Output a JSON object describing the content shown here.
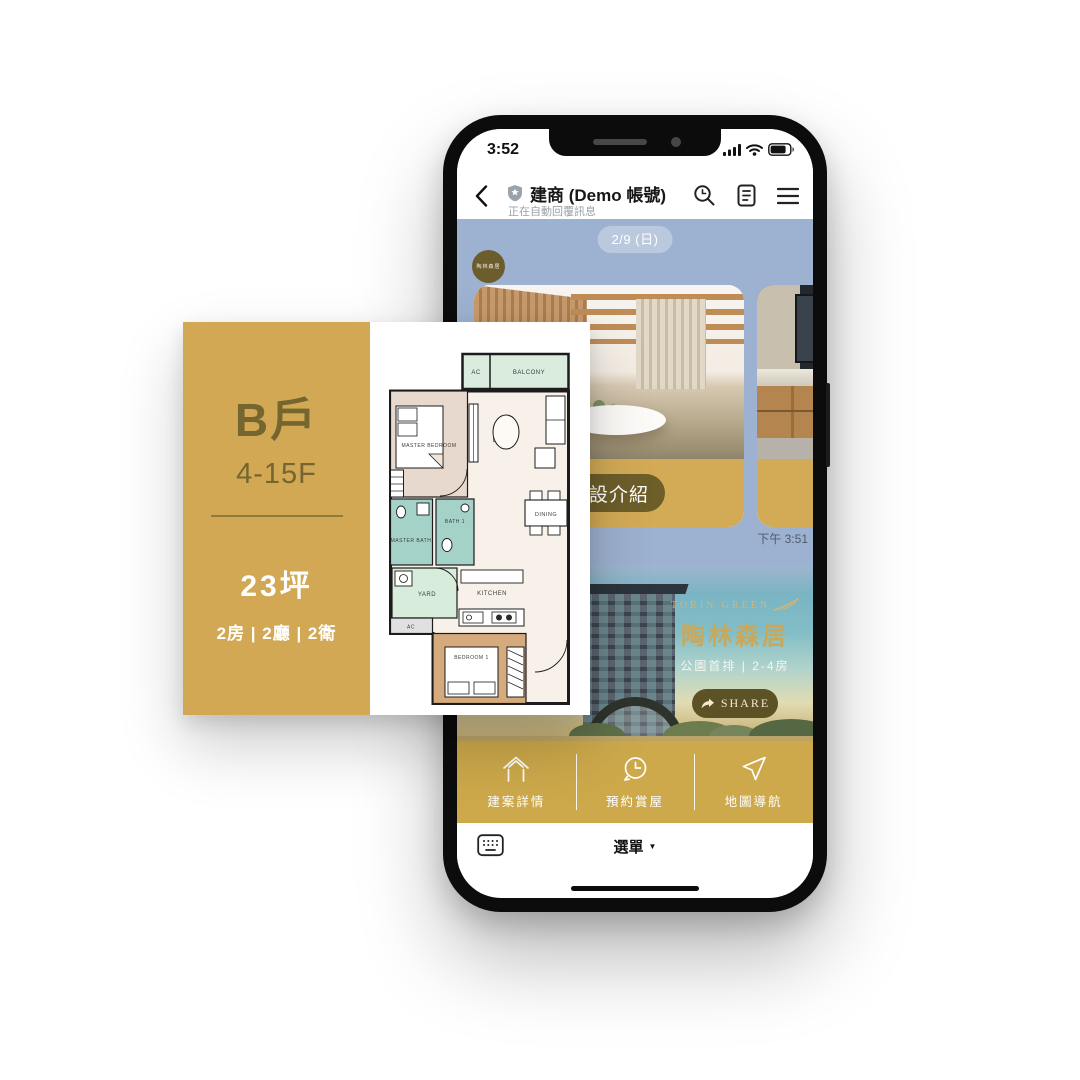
{
  "status_bar": {
    "time": "3:52"
  },
  "header": {
    "title": "建商 (Demo 帳號)",
    "subtitle": "正在自動回覆訊息"
  },
  "chat": {
    "date_badge": "2/9 (日)",
    "avatar_text": "陶林森居",
    "carousel_button": "公設介紹",
    "timestamp": "下午 3:51"
  },
  "promo": {
    "brand_en": "TORIN GREEN",
    "brand_zh": "陶林森居",
    "tagline": "公園首排 | 2-4房",
    "share_label": "SHARE"
  },
  "rich_menu": {
    "items": [
      {
        "icon": "house-icon",
        "label": "建案詳情"
      },
      {
        "icon": "clock-reserve-icon",
        "label": "預約賞屋"
      },
      {
        "icon": "navigation-arrow-icon",
        "label": "地圖導航"
      }
    ]
  },
  "input_bar": {
    "menu_label": "選單",
    "menu_caret": "▼"
  },
  "floorplan": {
    "unit": "B戶",
    "floors": "4-15F",
    "area": "23坪",
    "layout": "2房 | 2廳 | 2衛",
    "rooms": {
      "ac_top": "AC",
      "balcony": "BALCONY",
      "master_bedroom": "MASTER BEDROOM",
      "living": "LIVING",
      "bath1": "BATH 1",
      "master_bath": "MASTER BATH",
      "dining": "DINING",
      "yard": "YARD",
      "kitchen": "KITCHEN",
      "ac_bottom": "AC",
      "bedroom1": "BEDROOM 1"
    }
  },
  "colors": {
    "gold": "#d2a855",
    "rich_menu_gold": "#cda94b",
    "olive_button": "#6e5e2a",
    "chat_blue": "#9db2d0",
    "brand_gold": "#c9a85c"
  }
}
